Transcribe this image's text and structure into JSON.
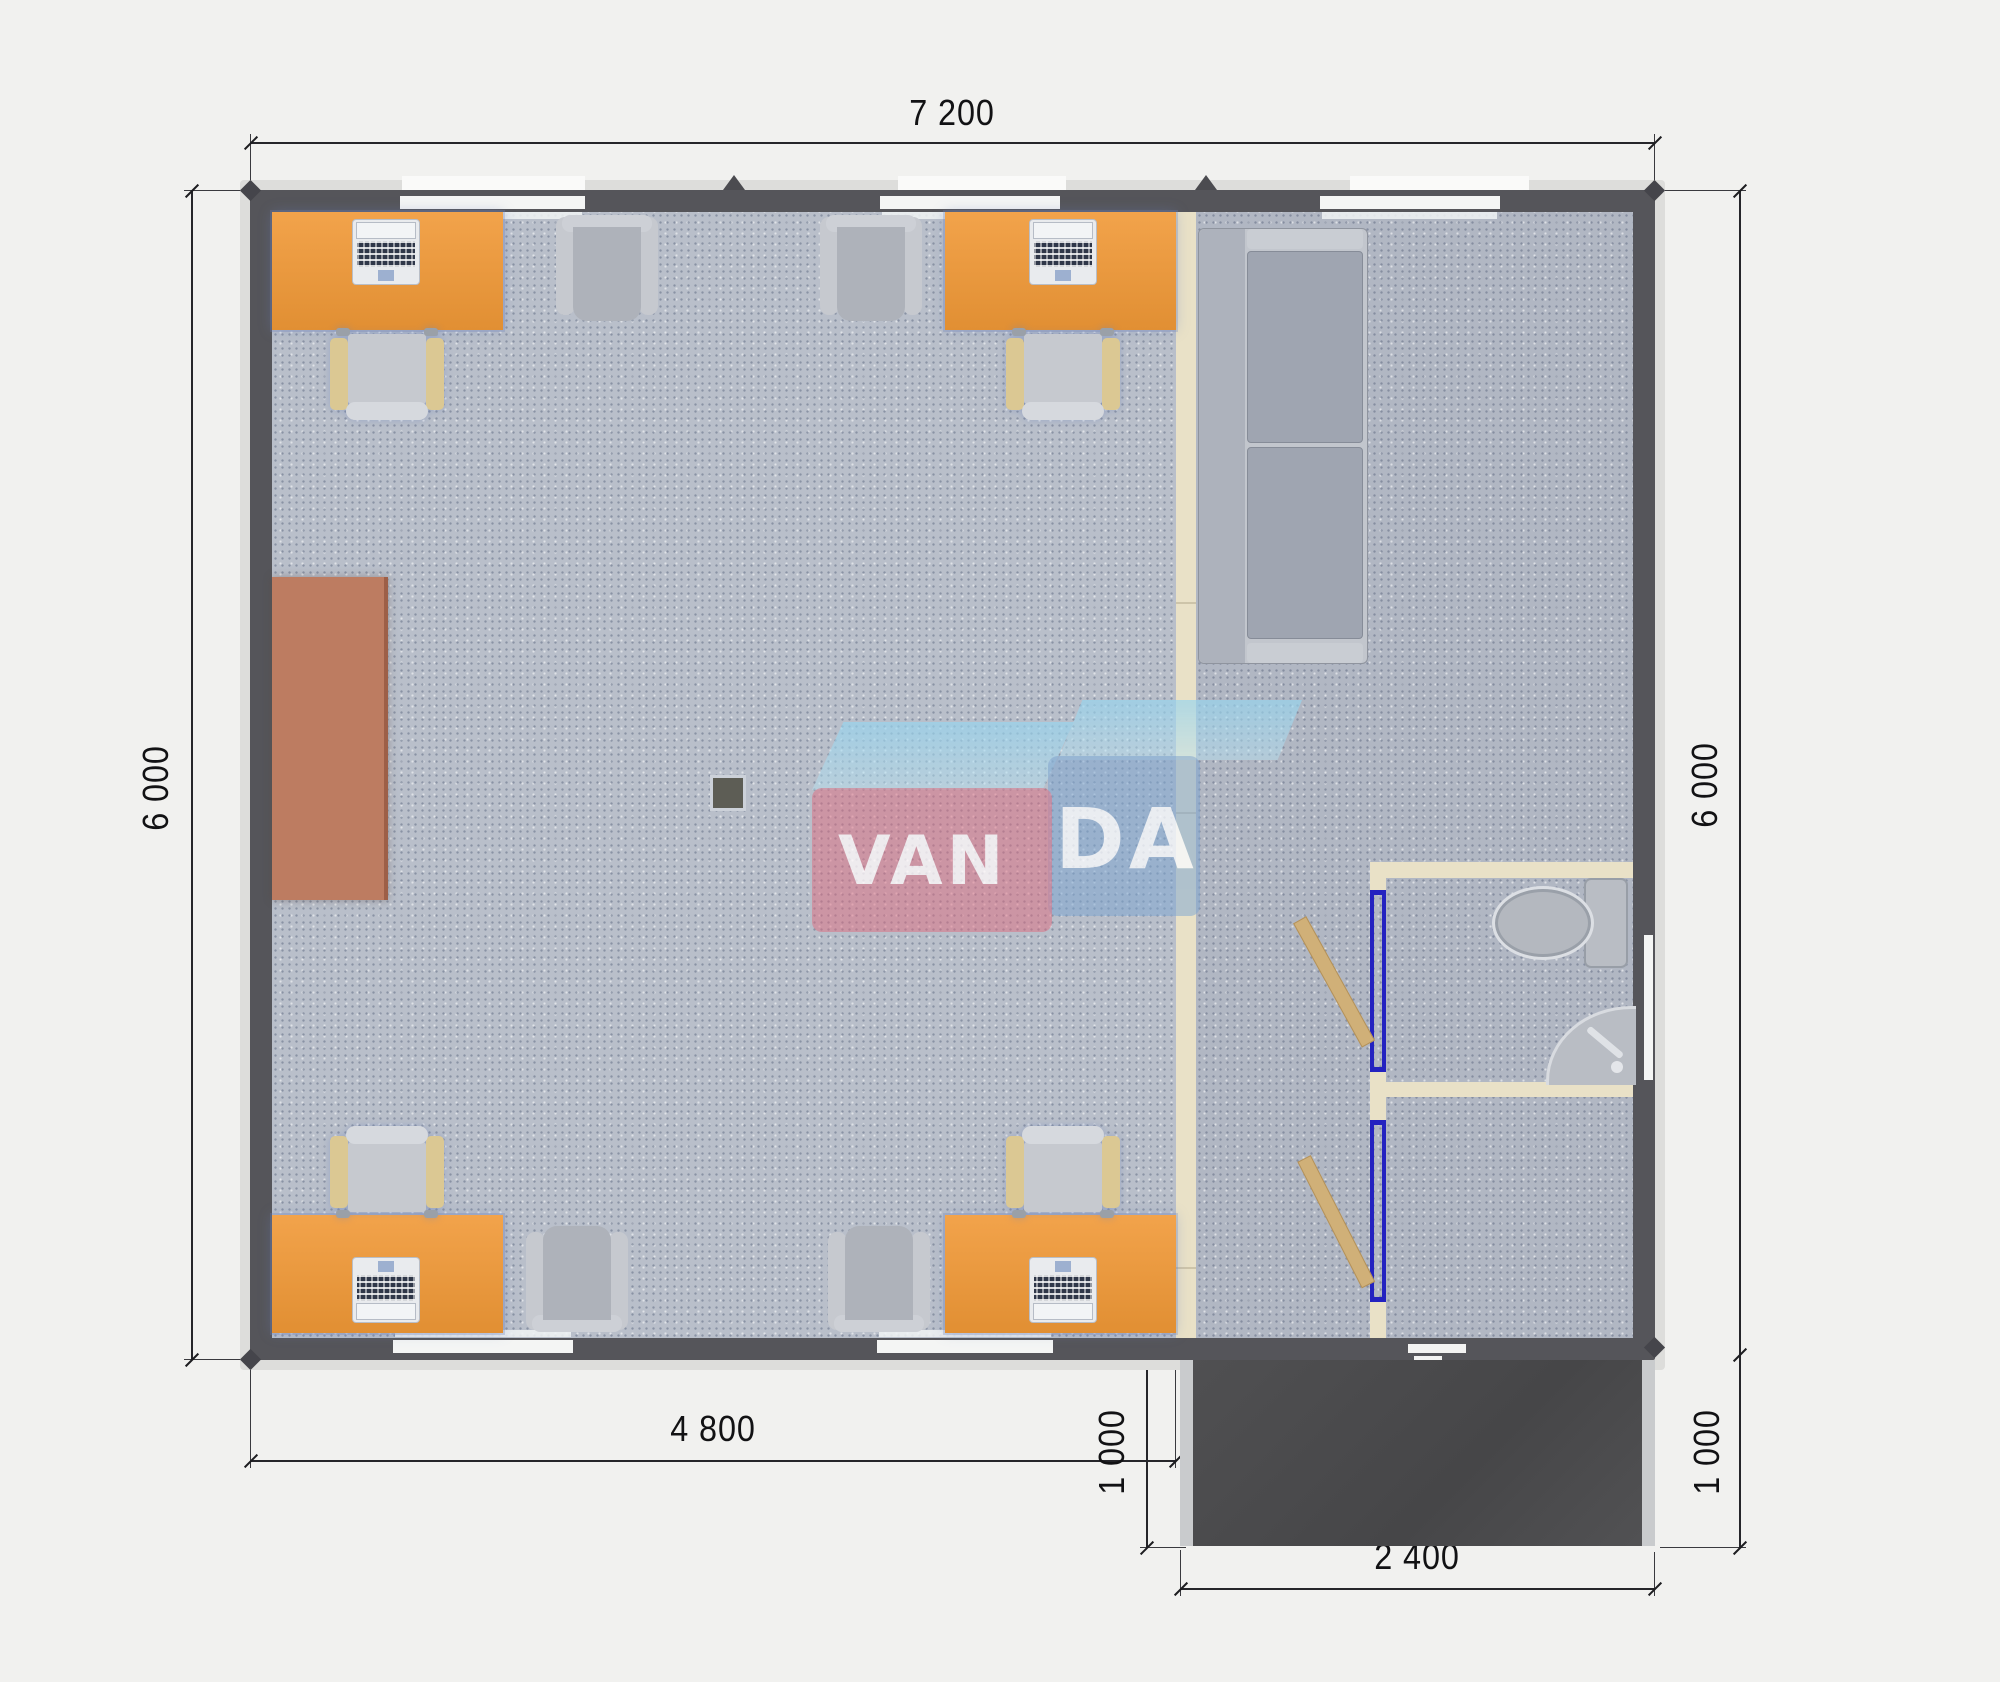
{
  "annotations": {
    "overall_width": "7 200",
    "left_height": "6 000",
    "right_height": "6 000",
    "office_width": "4 800",
    "porch_depth_left": "1 000",
    "porch_depth_right": "1 000",
    "porch_width": "2 400"
  },
  "watermark": {
    "left": "VAN",
    "right": "DA"
  },
  "palette": {
    "background": "#f1f1ef",
    "wall": "#55555a",
    "floor_office": "#b9bfca",
    "floor_right": "#b1b7c3",
    "partition": "#e9e1c7",
    "desk_orange": "#eb9a3d",
    "side_table_brown": "#bd7c61",
    "door_tan": "#d0b078",
    "door_frame_blue": "#2322c0",
    "porch_dark": "#4d4d4f",
    "furniture_gray": "#b4b8bf",
    "watermark_pink": "#e06a7e",
    "watermark_blue": "#7da5d2",
    "watermark_light_blue": "#9ed4ea"
  },
  "inventory": {
    "desks": 4,
    "laptops": 4,
    "office_chairs": 4,
    "armchairs": 4,
    "sofas": 1,
    "toilets": 1,
    "sinks": 1,
    "interior_doors": 2,
    "side_tables": 1
  }
}
